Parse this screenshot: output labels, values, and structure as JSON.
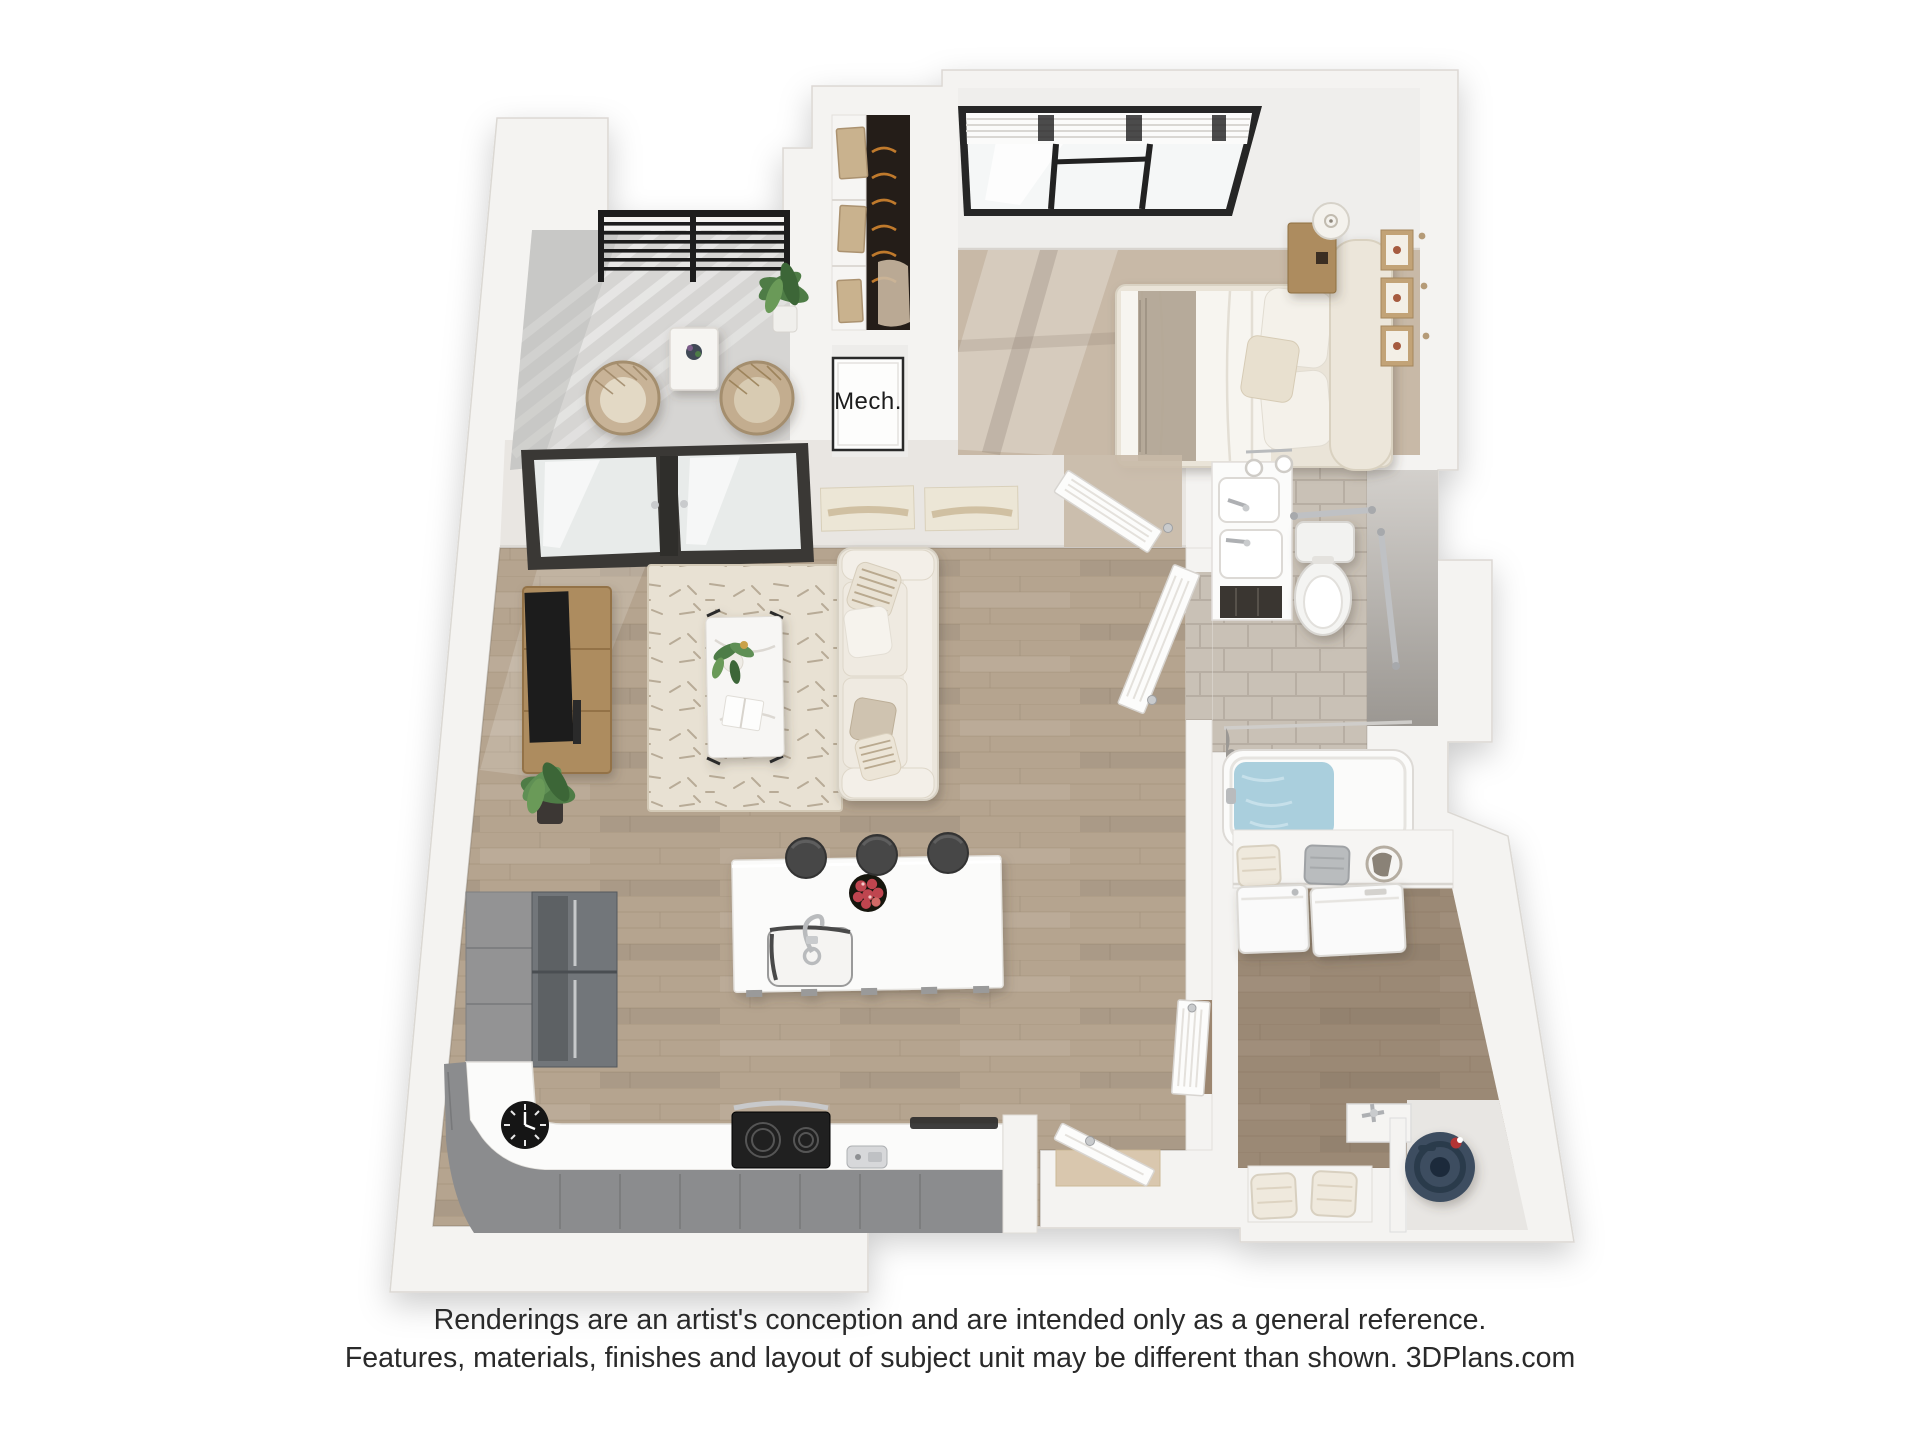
{
  "labels": {
    "mech": "Mech."
  },
  "footer": {
    "line1": "Renderings are an artist's conception and are intended only as a general reference.",
    "line2": "Features, materials, finishes and layout of subject unit may be different than shown. 3DPlans.com"
  },
  "colors": {
    "page_bg": "#ffffff",
    "wall": "#f4f3f1",
    "wall_edge": "#dbd8d3",
    "wall_face": "#e9e6e2",
    "wall_face_light": "#efeeec",
    "wood_floor": "#b5a48f",
    "wood_line": "#9e8c76",
    "carpet": "#c8b9a7",
    "tile": "#c9c1b6",
    "tile_grout": "#b7aea3",
    "concrete": "#d6d5d3",
    "rug": "#e8e1d3",
    "rug_texture": "#8f7f66",
    "sofa": "#ebe6dc",
    "cushion": "#f3efe8",
    "bed_frame": "#eae4d8",
    "duvet": "#f7f5f0",
    "throw_gray": "#b2a595",
    "wood_furniture": "#ad8c5f",
    "tv_black": "#1c1c1c",
    "counter_white": "#fbfbfa",
    "cabinet_gray": "#939394",
    "cabinet_front": "#8b8c8e",
    "fridge": "#72767a",
    "stove": "#202020",
    "chrome": "#bfc1c4",
    "railing": "#1d1d1d",
    "door_frame": "#3a3835",
    "door_white": "#fcfcfb",
    "water_heater": "#3d4e61",
    "tub_water": "#aacfdd",
    "apples": "#bf4550",
    "hangers": "#c07a2c",
    "plant": "#4e7c46",
    "plant_dark": "#3c6637",
    "laundry_tint": "#5b4632",
    "text": "#2a2a2a"
  }
}
